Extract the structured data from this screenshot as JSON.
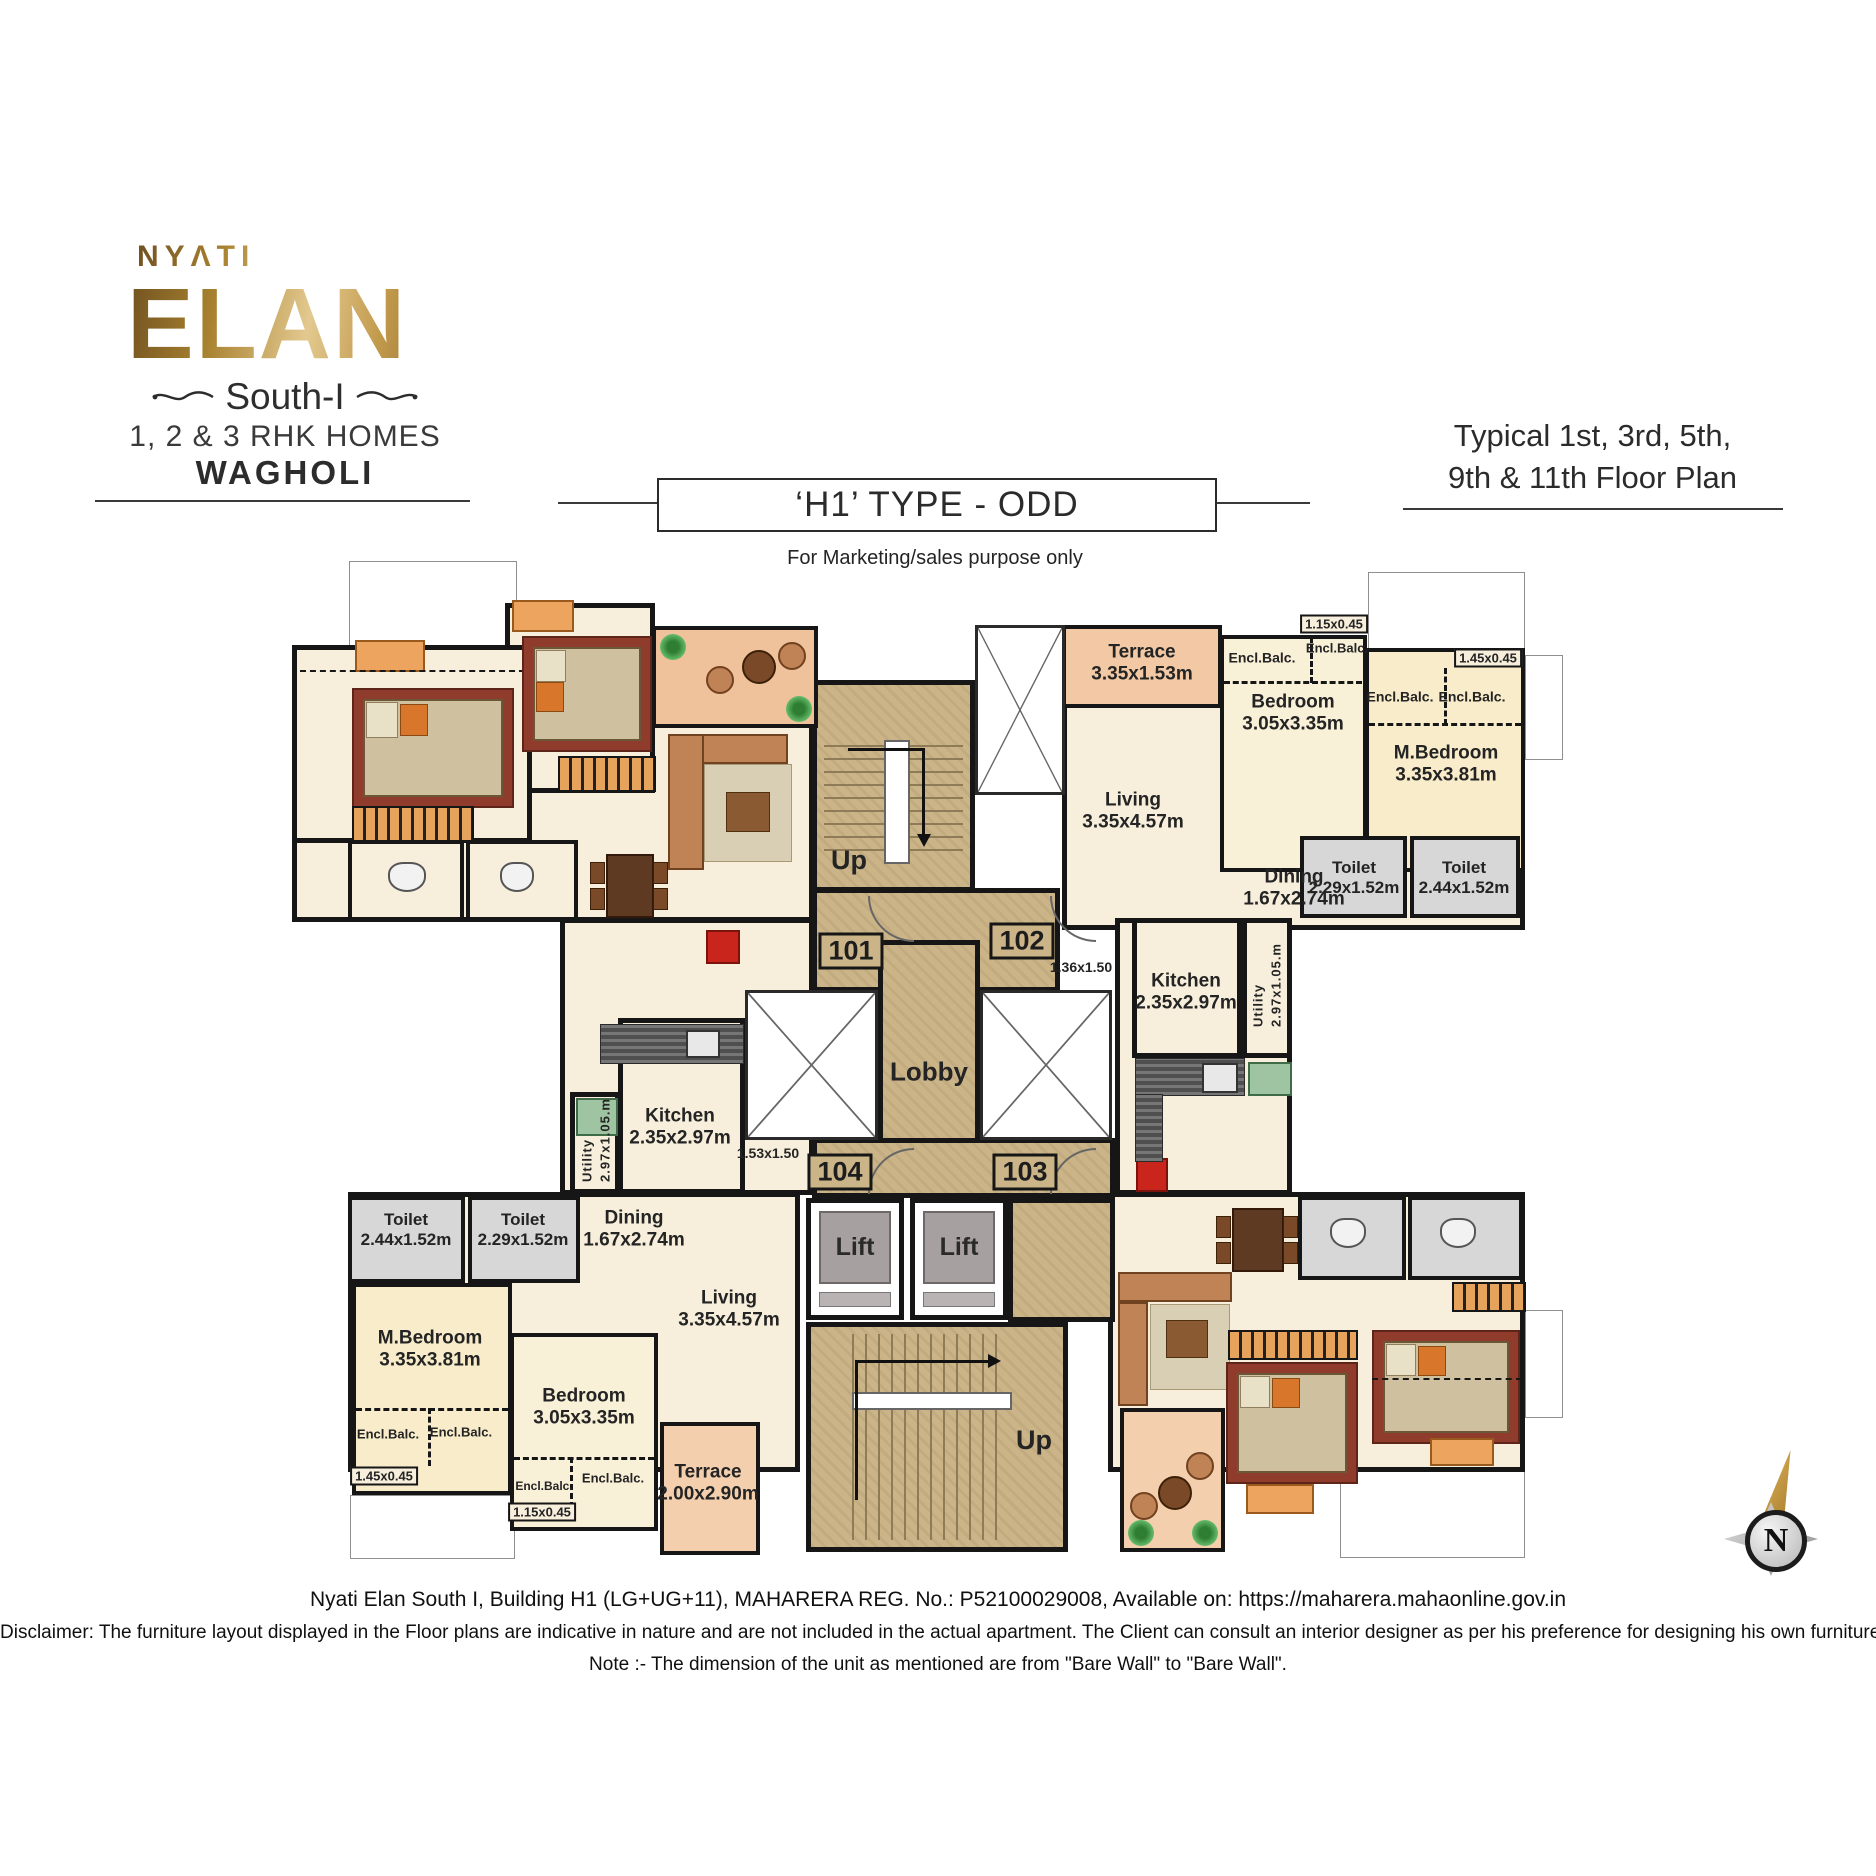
{
  "branding": {
    "brand": "NYΛTI",
    "project": "ELAN",
    "series": "South-I",
    "homes": "1, 2 & 3 RHK HOMES",
    "location": "WAGHOLI"
  },
  "header": {
    "type_title": "‘H1’ TYPE - ODD",
    "purpose": "For Marketing/sales purpose only",
    "floor_line1": "Typical 1st, 3rd, 5th,",
    "floor_line2": "9th & 11th Floor Plan"
  },
  "core": {
    "lobby": "Lobby",
    "up_top": "Up",
    "up_bottom": "Up",
    "lift": "Lift",
    "units": {
      "u101": "101",
      "u102": "102",
      "u103": "103",
      "u104": "104"
    }
  },
  "unit102": {
    "terrace_name": "Terrace",
    "terrace_dim": "3.35x1.53m",
    "encl_balc": "Encl.Balc.",
    "tag_small_balc": "1.15x0.45",
    "bedroom_name": "Bedroom",
    "bedroom_dim": "3.05x3.35m",
    "tag_corner_balc": "1.45x0.45",
    "mbedroom_name": "M.Bedroom",
    "mbedroom_dim": "3.35x3.81m",
    "living_name": "Living",
    "living_dim": "3.35x4.57m",
    "dining_name": "Dining",
    "dining_dim": "1.67x2.74m",
    "toilet1_name": "Toilet",
    "toilet1_dim": "2.29x1.52m",
    "toilet2_name": "Toilet",
    "toilet2_dim": "2.44x1.52m",
    "tag_passage": "1.36x1.50",
    "kitchen_name": "Kitchen",
    "kitchen_dim": "2.35x2.97m",
    "utility_name": "Utility",
    "utility_dim": "2.97x1.05.m"
  },
  "unit104": {
    "utility_name": "Utility",
    "utility_dim": "2.97x1.05.m",
    "kitchen_name": "Kitchen",
    "kitchen_dim": "2.35x2.97m",
    "tag_passage": "1.53x1.50",
    "toilet1_name": "Toilet",
    "toilet1_dim": "2.44x1.52m",
    "toilet2_name": "Toilet",
    "toilet2_dim": "2.29x1.52m",
    "dining_name": "Dining",
    "dining_dim": "1.67x2.74m",
    "living_name": "Living",
    "living_dim": "3.35x4.57m",
    "mbedroom_name": "M.Bedroom",
    "mbedroom_dim": "3.35x3.81m",
    "encl_balc": "Encl.Balc.",
    "tag_corner_balc": "1.45x0.45",
    "bedroom_name": "Bedroom",
    "bedroom_dim": "3.05x3.35m",
    "tag_small_balc": "1.15x0.45",
    "terrace_name": "Terrace",
    "terrace_dim": "2.00x2.90m"
  },
  "footer": {
    "reg_line": "Nyati Elan South I, Building H1 (LG+UG+11), MAHARERA REG. No.: P52100029008, Available on: https://maharera.mahaonline.gov.in",
    "disclaimer": "Disclaimer: The furniture layout displayed in the Floor plans are indicative in nature and are not included in the actual apartment. The Client can consult an interior designer as per his preference for designing his own furniture layout.",
    "note": "Note :- The dimension of the unit as mentioned are from \"Bare Wall\" to \"Bare Wall\"."
  },
  "compass": {
    "north": "N"
  },
  "colors": {
    "gold": "#b8924a",
    "wall": "#161616",
    "floor_tan": "#cbb488",
    "room_cream": "#f7efdc",
    "terrace_peach": "#f2c9a4",
    "toilet_gray": "#d7d7d7",
    "accent_red": "#c9251c"
  }
}
